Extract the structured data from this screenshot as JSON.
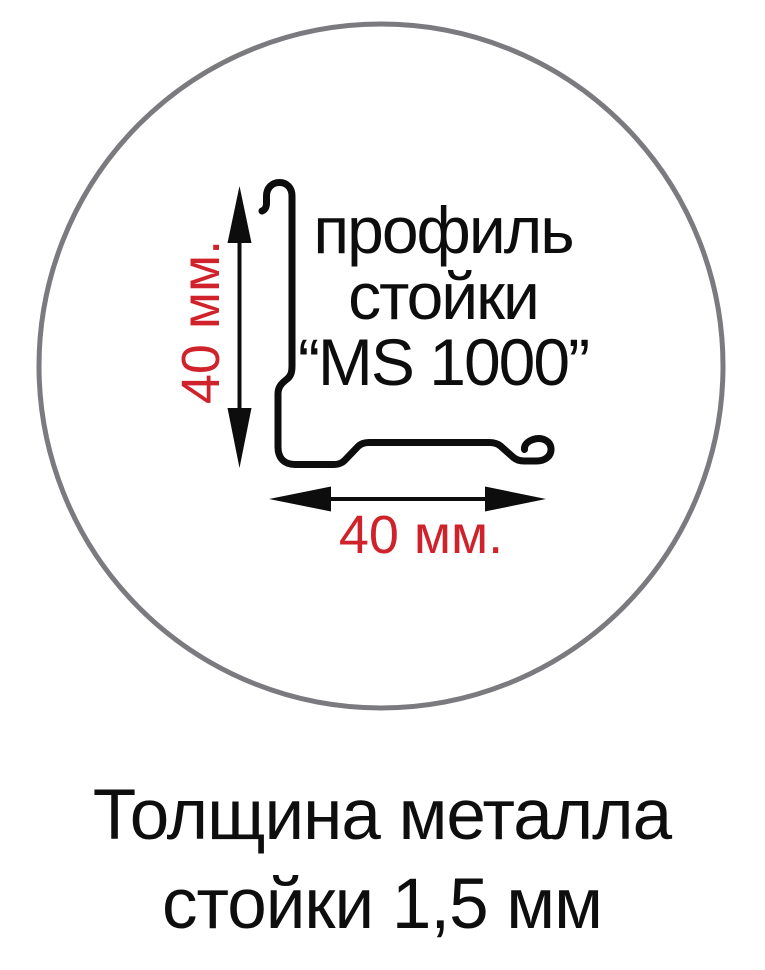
{
  "figure": {
    "profile_label": {
      "line1": "профиль",
      "line2": "стойки",
      "line3": "“MS 1000”"
    },
    "dimensions": {
      "vertical": "40 мм.",
      "horizontal": "40 мм."
    },
    "caption": {
      "line1": "Толщина металла",
      "line2": "стойки 1,5 мм"
    },
    "colors": {
      "drawing": "#0d0d0d",
      "dimension_text": "#cf222b",
      "circle_border": "#7b7b7f",
      "background": "#ffffff"
    },
    "icons": {
      "circle_outline": "circular-frame",
      "profile_drawing": "metal-stud-profile-cross-section",
      "vertical_arrow": "double-headed-vertical-arrow",
      "horizontal_arrow": "double-headed-horizontal-arrow"
    }
  }
}
